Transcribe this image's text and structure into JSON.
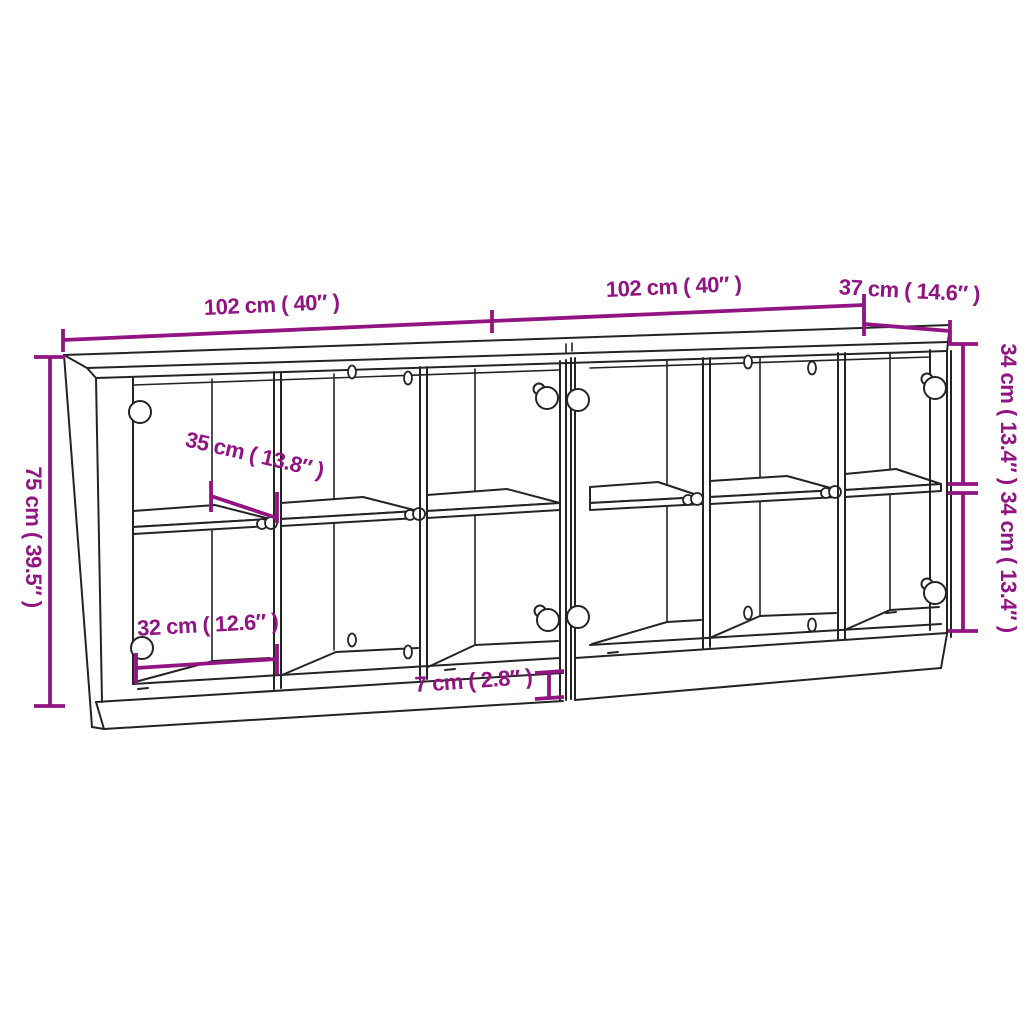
{
  "colors": {
    "dimension": "#921482",
    "line": "#242424",
    "bg": "#ffffff"
  },
  "dimensions": {
    "width_left": "102 cm ( 40″ )",
    "width_right": "102 cm ( 40″ )",
    "depth": "37 cm ( 14.6″ )",
    "height": "75 cm ( 39.5″ )",
    "upper_section": "34 cm ( 13.4″ )",
    "lower_section": "34 cm ( 13.4″ )",
    "shelf_depth": "35 cm ( 13.8″ )",
    "compartment_width": "32 cm ( 12.6″ )",
    "plinth_height": "7 cm ( 2.8″ )"
  }
}
